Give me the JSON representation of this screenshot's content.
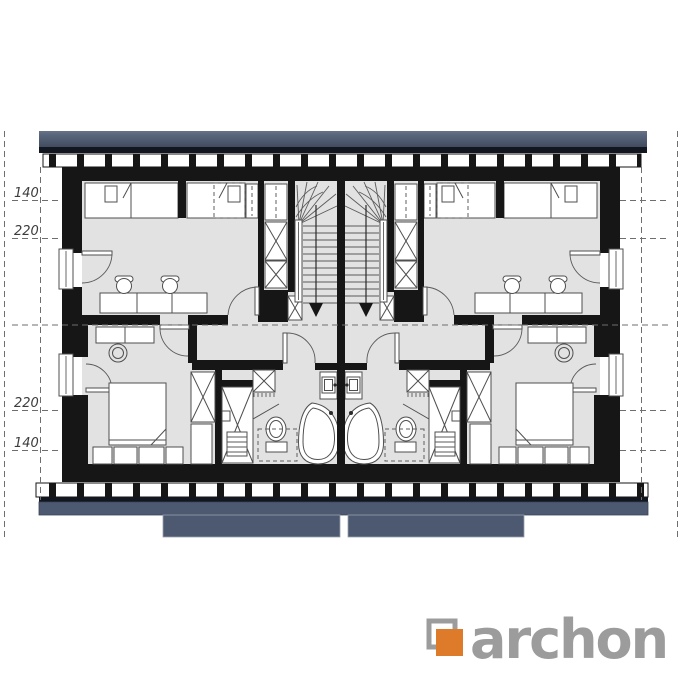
{
  "plan": {
    "dimension_labels": [
      {
        "text": "140"
      },
      {
        "text": "220"
      },
      {
        "text": "220"
      },
      {
        "text": "140"
      }
    ]
  },
  "logo": {
    "text": "archon"
  },
  "colors": {
    "roof_slate": "#55617a",
    "roof_edge": "#11161f",
    "navy_band": "#4d5970",
    "wall_black": "#161616",
    "floor_gray": "#e2e2e2",
    "accent_orange": "#dd7b2b",
    "logo_gray": "#9c9c9c"
  }
}
